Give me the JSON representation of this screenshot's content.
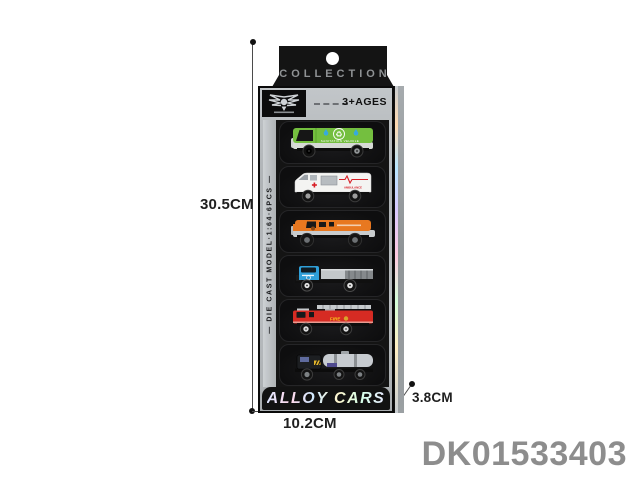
{
  "annotation": {
    "height_label": "30.5CM",
    "width_label": "10.2CM",
    "depth_label": "3.8CM",
    "product_code": "DK01533403"
  },
  "box": {
    "tab_title": "COLLECTION",
    "age_label": "3+AGES",
    "side_text": "— DIE CAST MODEL·1:64·6PCS —",
    "bottom_title": "ALLOY CARS",
    "logo_icon": "winged-badge-icon",
    "colors": {
      "box_black": "#141414",
      "frame_silver": "#b9bdc0",
      "holographic_edge": "#b8e6ff"
    }
  },
  "vehicles": [
    {
      "name": "sanitation-truck",
      "label": "SANITATION VEHICLE",
      "color": "#74bf3f",
      "icons": [
        "recycle-icon",
        "water-drop-icon"
      ]
    },
    {
      "name": "ambulance-van",
      "label": "AMBULANCE",
      "color": "#f4f4f2",
      "icons": [
        "red-cross-icon",
        "heartbeat-icon"
      ]
    },
    {
      "name": "armored-truck",
      "label": "",
      "color": "#e87820",
      "icons": []
    },
    {
      "name": "flatbed-truck",
      "label": "",
      "color": "#2f9fd8",
      "icons": []
    },
    {
      "name": "fire-truck",
      "label": "FIRE",
      "color": "#d62b23",
      "icons": [
        "ladder-icon"
      ]
    },
    {
      "name": "tanker-truck",
      "label": "",
      "color": "#1d1f22",
      "icons": [
        "hazard-stripe-icon"
      ]
    }
  ]
}
